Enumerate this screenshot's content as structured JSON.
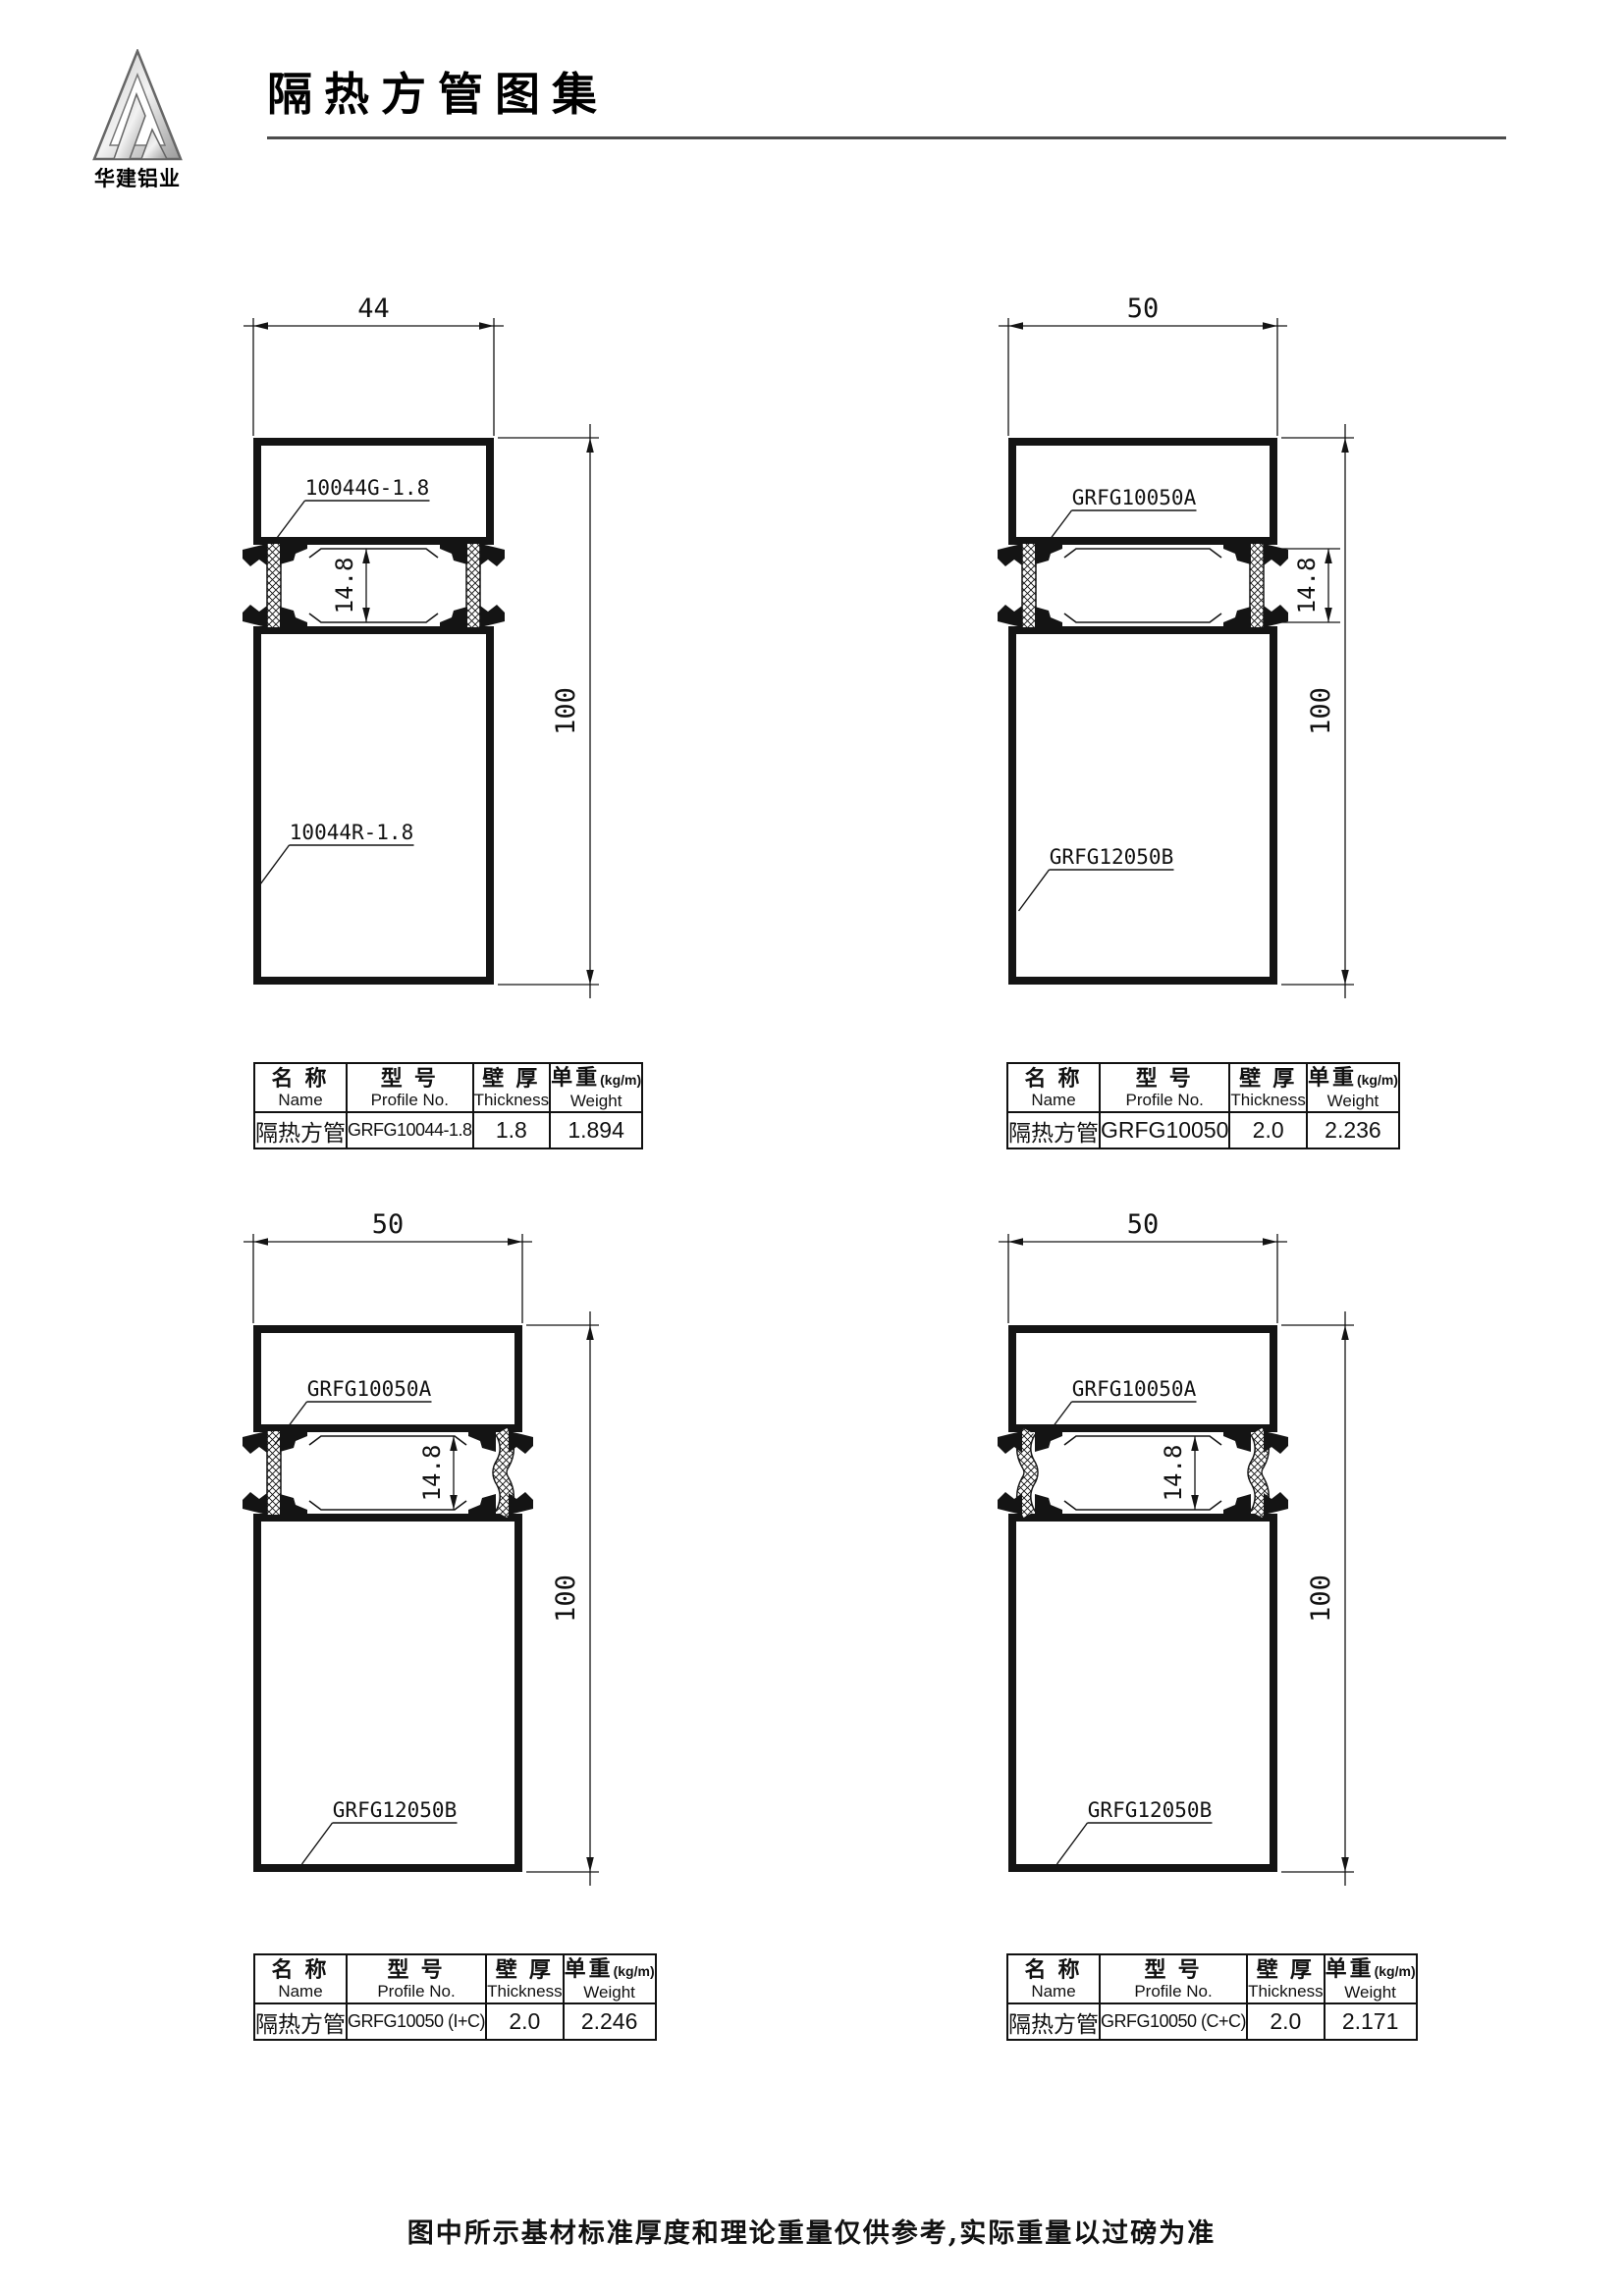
{
  "header": {
    "title": "隔热方管图集",
    "brand": "华建铝业"
  },
  "table_headers": {
    "name_zh": "名 称",
    "name_en": "Name",
    "profile_zh": "型 号",
    "profile_en": "Profile No.",
    "thickness_zh": "壁 厚",
    "thickness_en": "Thickness",
    "weight_zh": "单重",
    "weight_unit": "(kg/m)",
    "weight_en": "Weight"
  },
  "drawings": [
    {
      "width_dim": "44",
      "height_dim": "100",
      "gap_dim": "14.8",
      "top_label": "10044G-1.8",
      "bottom_label": "10044R-1.8",
      "left_strip": "I",
      "right_strip": "I",
      "gap_dim_style": "inside",
      "table": {
        "name": "隔热方管",
        "profile_no": "GRFG10044-1.8",
        "thickness": "1.8",
        "weight": "1.894"
      }
    },
    {
      "width_dim": "50",
      "height_dim": "100",
      "gap_dim": "14.8",
      "top_label": "GRFG10050A",
      "bottom_label": "GRFG12050B",
      "left_strip": "I",
      "right_strip": "I",
      "gap_dim_style": "outside",
      "table": {
        "name": "隔热方管",
        "profile_no": "GRFG10050",
        "thickness": "2.0",
        "weight": "2.236"
      }
    },
    {
      "width_dim": "50",
      "height_dim": "100",
      "gap_dim": "14.8",
      "top_label": "GRFG10050A",
      "bottom_label": "GRFG12050B",
      "left_strip": "I",
      "right_strip": "C",
      "gap_dim_style": "inside",
      "table": {
        "name": "隔热方管",
        "profile_no": "GRFG10050 (I+C)",
        "thickness": "2.0",
        "weight": "2.246"
      }
    },
    {
      "width_dim": "50",
      "height_dim": "100",
      "gap_dim": "14.8",
      "top_label": "GRFG10050A",
      "bottom_label": "GRFG12050B",
      "left_strip": "C",
      "right_strip": "C",
      "gap_dim_style": "inside",
      "table": {
        "name": "隔热方管",
        "profile_no": "GRFG10050 (C+C)",
        "thickness": "2.0",
        "weight": "2.171"
      }
    }
  ],
  "footer": {
    "note": "图中所示基材标准厚度和理论重量仅供参考,实际重量以过磅为准"
  }
}
